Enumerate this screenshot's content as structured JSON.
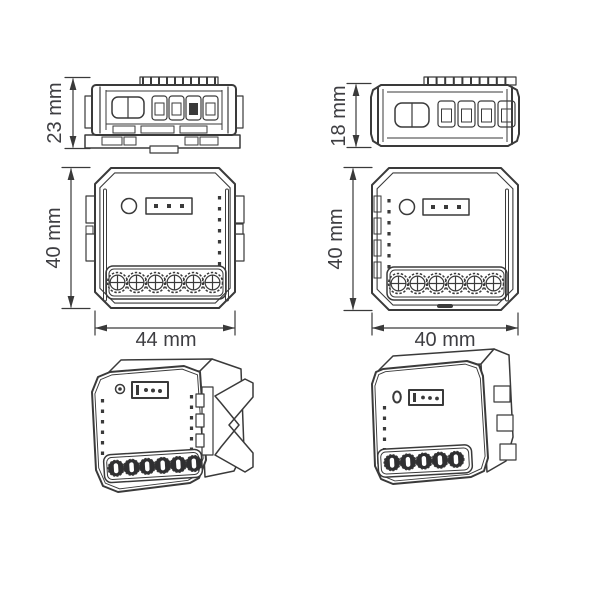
{
  "colors": {
    "background": "#ffffff",
    "line": "#3a3a3a",
    "dimension_text": "#3e3e42"
  },
  "devices": {
    "left": {
      "depth_label": "23 mm",
      "height_label": "40 mm",
      "width_label": "44 mm",
      "terminal_count": 6,
      "header_pin_count": 3
    },
    "right": {
      "depth_label": "18 mm",
      "height_label": "40 mm",
      "width_label": "40 mm",
      "terminal_count": 6,
      "header_pin_count": 3
    }
  }
}
